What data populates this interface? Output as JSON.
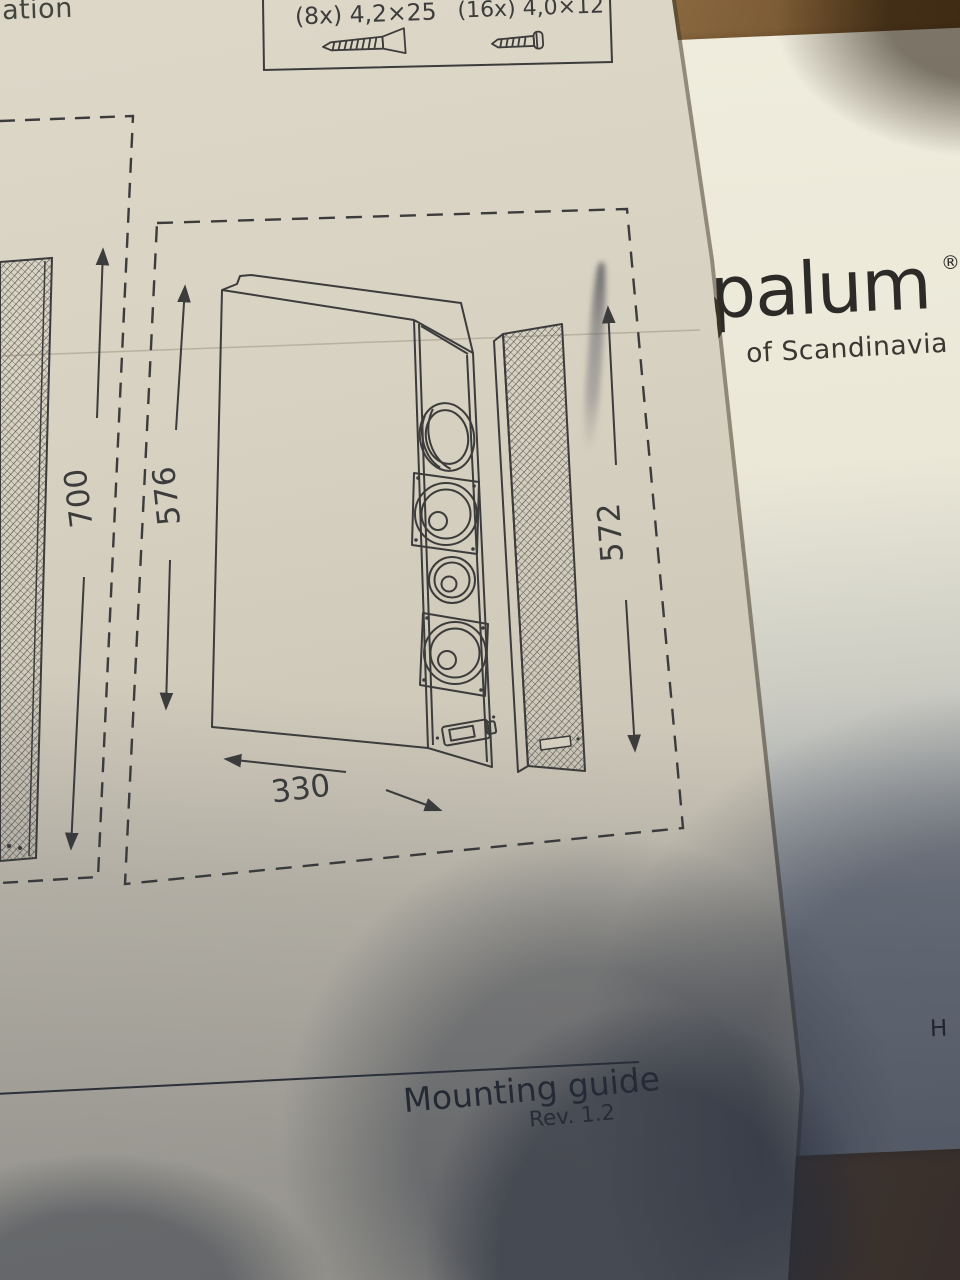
{
  "guide": {
    "partial_heading": "ation",
    "hardware_box": {
      "items": [
        {
          "label": "(8x) 4,2×25",
          "icon": "countersunk-screw-icon"
        },
        {
          "label": "(16x) 4,0×12",
          "icon": "panhead-screw-icon"
        }
      ]
    },
    "dimensions": {
      "left_speaker_height": "700",
      "cabinet_height": "576",
      "grille_height": "572",
      "cabinet_depth": "330"
    },
    "footer": {
      "title": "Mounting guide",
      "revision": "Rev. 1.2"
    }
  },
  "brochure": {
    "logo_partial": "palum",
    "registered_mark": "®",
    "tagline": "of Scandinavia",
    "partial_text_right_edge": "H"
  },
  "colors": {
    "ink": "#3c3c3c",
    "guide_paper": "#d8d2c2",
    "brochure_paper": "#ece9da",
    "wood": "#7d5c32",
    "shadow": "#282e3c"
  }
}
